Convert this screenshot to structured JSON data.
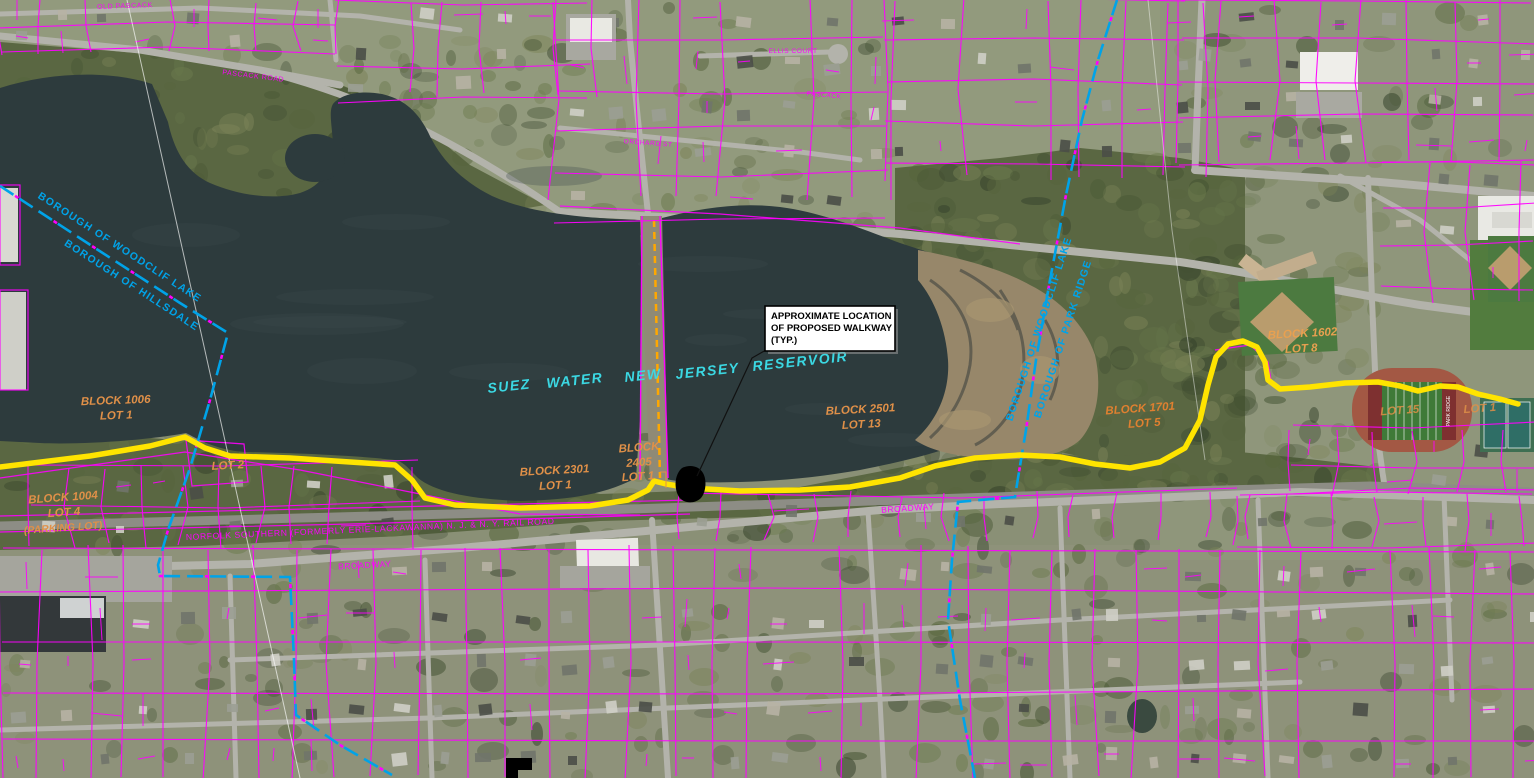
{
  "map": {
    "title": "Aerial parcel map - proposed walkway at Suez Water New Jersey Reservoir",
    "callout": {
      "l1": "APPROXIMATE LOCATION",
      "l2": "OF PROPOSED WALKWAY",
      "l3": "(TYP.)"
    },
    "reservoir": {
      "w0": "SUEZ",
      "w1": "WATER",
      "w2": "NEW",
      "w3": "JERSEY",
      "w4": "RESERVOIR"
    },
    "parcels": [
      {
        "l1": "BLOCK 1006",
        "l2": "LOT 1"
      },
      {
        "l1": "LOT 2"
      },
      {
        "l1": "BLOCK 1004",
        "l2": "LOT 4",
        "l3": "(PARKING LOT)"
      },
      {
        "l1": "BLOCK 2301",
        "l2": "LOT 1"
      },
      {
        "l1": "BLOCK",
        "l2": "2405",
        "l3": "LOT 1"
      },
      {
        "l1": "BLOCK 2501",
        "l2": "LOT 13"
      },
      {
        "l1": "BLOCK 1701",
        "l2": "LOT 5"
      },
      {
        "l1": "BLOCK 1602",
        "l2": "LOT 8"
      },
      {
        "l1": "LOT 15"
      },
      {
        "l1": "LOT 1"
      }
    ],
    "boundaries": {
      "nw1": "BOROUGH OF WOODCLIF LAKE",
      "nw2": "BOROUGH OF HILLSDALE",
      "e1": "BOROUGH OF WOODCLIF LAKE",
      "e2": "BOROUGH OF PARK RIDGE"
    },
    "streets": {
      "railroad": "NORFOLK SOUTHERN (FORMERLY ERIE-LACKAWANNA) N. J. & N. Y. RAIL ROAD",
      "broadway_e": "BROADWAY",
      "broadway_w": "BROADWAY",
      "old_pascack": "OLD PASCACK",
      "pascack_road": "PASCACK ROAD",
      "ellis_court": "ELLIS COURT",
      "pascack": "PASCACK",
      "orchard": "ORCHARD ST"
    },
    "field_text": "PARK RIDGE",
    "colors": {
      "parcel": "#FF00FF",
      "boundary": "#00A3E8",
      "walkway": "#FFE400",
      "causeway_dash": "#FFA800",
      "reservoir_text": "#3BD8E3",
      "lot_text": "#E09048",
      "water": "#2D3B3D",
      "mudflat": "#97876A"
    }
  }
}
